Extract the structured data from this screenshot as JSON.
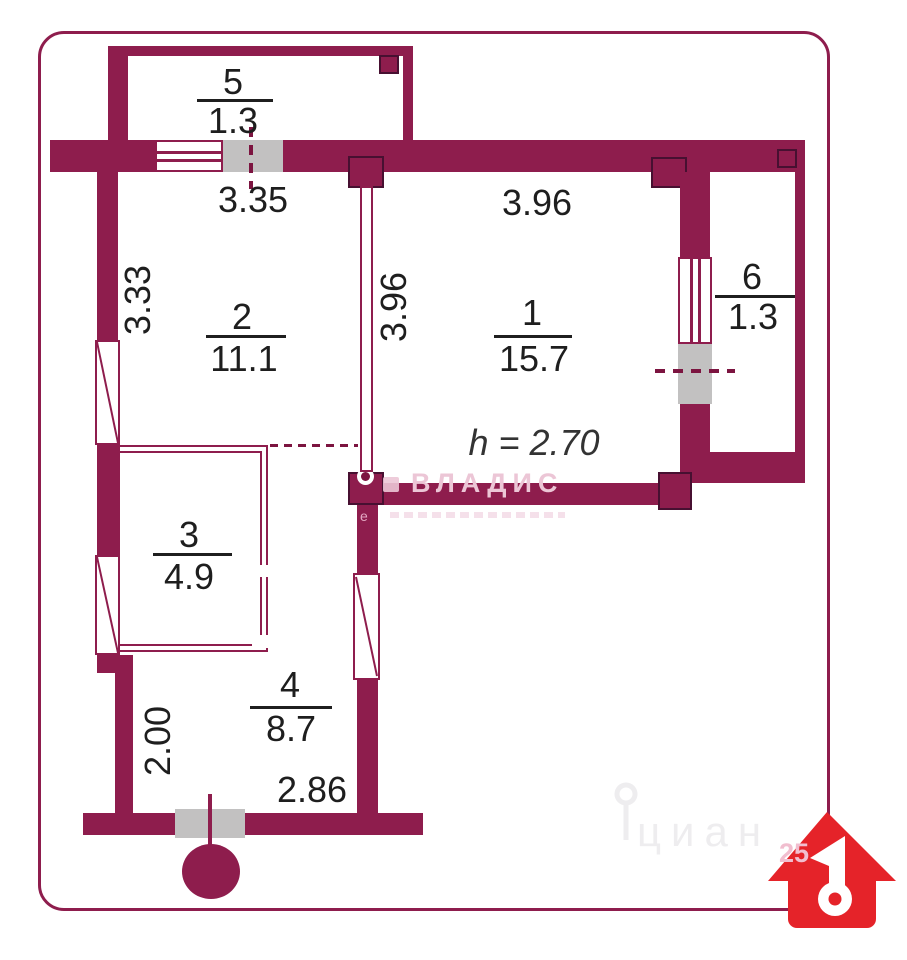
{
  "title": "apartment-floor-plan",
  "rooms": [
    {
      "number": "1",
      "area": "15.7"
    },
    {
      "number": "2",
      "area": "11.1"
    },
    {
      "number": "3",
      "area": "4.9"
    },
    {
      "number": "4",
      "area": "8.7"
    },
    {
      "number": "5",
      "area": "1.3"
    },
    {
      "number": "6",
      "area": "1.3"
    }
  ],
  "dimensions": {
    "balcony_door_width": "3.35",
    "left_wall_height": "3.33",
    "partition_length": "3.96",
    "room1_width": "3.96",
    "hall_height": "2.00",
    "hall_width": "2.86"
  },
  "ceiling_height_note": "h = 2.70",
  "watermarks": {
    "agency": "ВЛАДИС",
    "agency_small_letter": "е",
    "portal": "циан",
    "portal_number": "25",
    "house_digit": "1"
  },
  "colors": {
    "wall": "#8e1d4d",
    "wallEdge": "#471031",
    "doorGray": "#c2c1c1",
    "dashRed": "#7c1440",
    "text": "#1e1e1e",
    "houseRed": "#e52329",
    "pinkWm": "#ecc6d6",
    "grayWm": "#eeedef"
  }
}
